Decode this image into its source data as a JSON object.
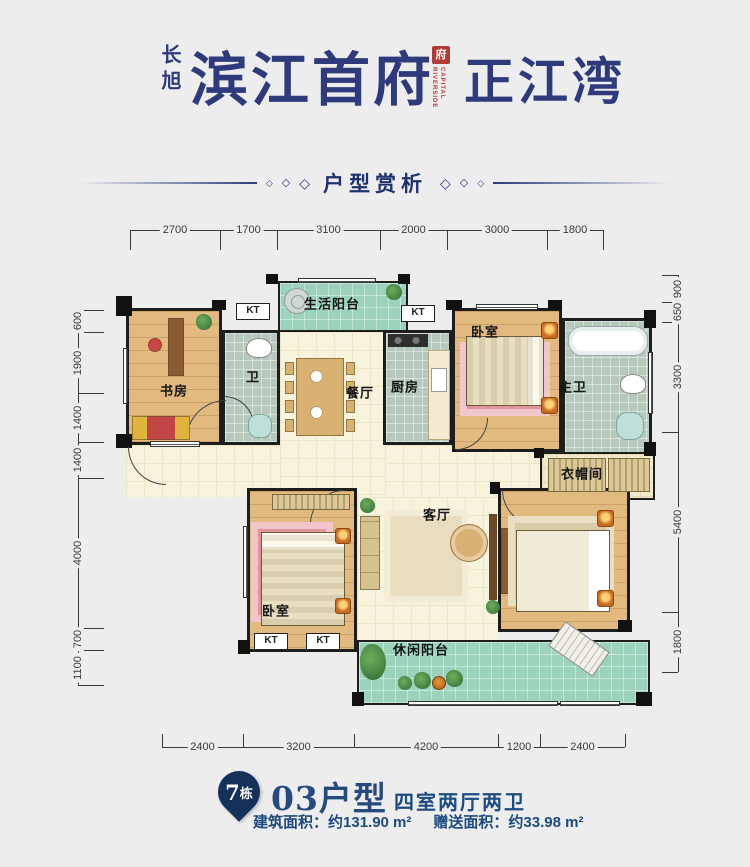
{
  "header": {
    "brand": "长旭",
    "title": "滨江首府",
    "seal_char": "府",
    "seal_caption": "RIVERSIDE CAPITAL",
    "subtitle_right": "正江湾"
  },
  "divider": {
    "label": "户型赏析",
    "diamond": "◇"
  },
  "plan": {
    "kt_text": "KT",
    "floors": [
      [
        "corridor",
        126,
        445,
        154,
        52
      ],
      [
        "dining-hall",
        280,
        332,
        105,
        165
      ],
      [
        "passage",
        385,
        445,
        177,
        52
      ],
      [
        "living-hall",
        357,
        497,
        141,
        143
      ]
    ],
    "rooms": [
      [
        "study",
        "wood",
        126,
        308,
        96,
        137,
        0
      ],
      [
        "bath",
        "tile",
        222,
        330,
        58,
        115,
        0
      ],
      [
        "life-balcony",
        "green",
        278,
        281,
        130,
        51,
        1
      ],
      [
        "kitchen",
        "tile",
        383,
        330,
        69,
        115,
        0
      ],
      [
        "bedroom-north",
        "wood",
        452,
        308,
        110,
        144,
        0
      ],
      [
        "master-bath",
        "tile",
        562,
        318,
        90,
        137,
        0
      ],
      [
        "cloakroom",
        "cream2",
        540,
        452,
        115,
        48,
        1
      ],
      [
        "bedroom-west",
        "wood",
        247,
        488,
        110,
        164,
        0
      ],
      [
        "master-bedroom",
        "wood",
        498,
        488,
        132,
        144,
        0
      ],
      [
        "leisure-balcony",
        "green",
        357,
        640,
        293,
        65,
        1
      ]
    ],
    "room_labels": [
      [
        "书房",
        174,
        390
      ],
      [
        "卫",
        253,
        376
      ],
      [
        "生活阳台",
        332,
        303
      ],
      [
        "餐厅",
        360,
        392
      ],
      [
        "厨房",
        405,
        386
      ],
      [
        "卧室",
        485,
        331
      ],
      [
        "主卫",
        573,
        386
      ],
      [
        "衣帽间",
        582,
        473
      ],
      [
        "客厅",
        437,
        514
      ],
      [
        "卧室",
        276,
        610
      ],
      [
        "休闲阳台",
        421,
        649
      ]
    ],
    "kt_positions": [
      [
        236,
        303
      ],
      [
        401,
        305
      ],
      [
        254,
        633
      ],
      [
        306,
        633
      ]
    ],
    "piers": [
      [
        116,
        296,
        16,
        20
      ],
      [
        212,
        300,
        14,
        10
      ],
      [
        266,
        274,
        12,
        10
      ],
      [
        398,
        274,
        12,
        10
      ],
      [
        446,
        300,
        16,
        10
      ],
      [
        548,
        300,
        14,
        10
      ],
      [
        644,
        310,
        12,
        18
      ],
      [
        644,
        442,
        12,
        14
      ],
      [
        618,
        620,
        14,
        12
      ],
      [
        636,
        692,
        16,
        14
      ],
      [
        352,
        692,
        12,
        14
      ],
      [
        238,
        640,
        12,
        14
      ],
      [
        116,
        434,
        16,
        14
      ],
      [
        490,
        482,
        10,
        12
      ],
      [
        534,
        448,
        10,
        10
      ]
    ],
    "windows": [
      [
        123,
        348,
        5,
        56,
        "v"
      ],
      [
        150,
        441,
        50,
        6,
        "h"
      ],
      [
        298,
        278,
        78,
        5,
        "h"
      ],
      [
        476,
        304,
        62,
        6,
        "h"
      ],
      [
        648,
        352,
        5,
        62,
        "v"
      ],
      [
        243,
        526,
        5,
        72,
        "v"
      ],
      [
        408,
        701,
        150,
        5,
        "h"
      ],
      [
        560,
        701,
        60,
        5,
        "h"
      ]
    ],
    "doors": [
      [
        128,
        447,
        38,
        0
      ],
      [
        186,
        400,
        40,
        90
      ],
      [
        224,
        396,
        30,
        180
      ],
      [
        456,
        418,
        32,
        270
      ],
      [
        310,
        490,
        34,
        90
      ],
      [
        502,
        490,
        36,
        0
      ]
    ],
    "furniture": [
      [
        "desk",
        168,
        318,
        16,
        58,
        0
      ],
      [
        "chair",
        148,
        338,
        14,
        14,
        0
      ],
      [
        "sofa",
        132,
        416,
        58,
        24,
        0
      ],
      [
        "plant",
        196,
        314,
        16,
        16,
        0
      ],
      [
        "toilet",
        246,
        338,
        26,
        20,
        0
      ],
      [
        "sink",
        248,
        414,
        24,
        24,
        0
      ],
      [
        "washer",
        284,
        288,
        26,
        26,
        0
      ],
      [
        "plant",
        386,
        284,
        16,
        16,
        0
      ],
      [
        "table",
        296,
        358,
        48,
        78,
        0
      ],
      [
        "chair-s",
        285,
        362,
        9,
        13,
        0
      ],
      [
        "chair-s",
        285,
        381,
        9,
        13,
        0
      ],
      [
        "chair-s",
        285,
        400,
        9,
        13,
        0
      ],
      [
        "chair-s",
        285,
        419,
        9,
        13,
        0
      ],
      [
        "chair-s",
        346,
        362,
        9,
        13,
        0
      ],
      [
        "chair-s",
        346,
        381,
        9,
        13,
        0
      ],
      [
        "chair-s",
        346,
        400,
        9,
        13,
        0
      ],
      [
        "chair-s",
        346,
        419,
        9,
        13,
        0
      ],
      [
        "plate",
        310,
        370,
        13,
        13,
        0
      ],
      [
        "plate",
        310,
        406,
        13,
        13,
        0
      ],
      [
        "stove",
        388,
        334,
        40,
        13,
        0
      ],
      [
        "counter",
        428,
        350,
        22,
        90,
        0
      ],
      [
        "ksink",
        431,
        368,
        16,
        24,
        0
      ],
      [
        "rug",
        460,
        342,
        90,
        74,
        0
      ],
      [
        "bed-h",
        466,
        336,
        78,
        70,
        0
      ],
      [
        "ns",
        541,
        322,
        17,
        17,
        0
      ],
      [
        "ns",
        541,
        397,
        17,
        17,
        0
      ],
      [
        "tub",
        568,
        326,
        80,
        30,
        0
      ],
      [
        "toilet",
        620,
        374,
        26,
        20,
        0
      ],
      [
        "sink",
        616,
        412,
        28,
        28,
        0
      ],
      [
        "hatch",
        548,
        458,
        58,
        34,
        0
      ],
      [
        "hatch",
        608,
        458,
        42,
        34,
        0
      ],
      [
        "sofa-v",
        360,
        516,
        20,
        74,
        0
      ],
      [
        "rug-c",
        384,
        510,
        84,
        92,
        0
      ],
      [
        "rtable",
        450,
        524,
        38,
        38,
        0
      ],
      [
        "plant",
        360,
        498,
        15,
        15,
        0
      ],
      [
        "tv",
        489,
        514,
        8,
        86,
        0
      ],
      [
        "plant",
        486,
        600,
        14,
        14,
        0
      ],
      [
        "hatch",
        272,
        494,
        78,
        16,
        0
      ],
      [
        "rug",
        251,
        522,
        82,
        100,
        0
      ],
      [
        "bed-v",
        261,
        532,
        84,
        94,
        0
      ],
      [
        "ns",
        335,
        528,
        16,
        16,
        0
      ],
      [
        "ns",
        335,
        598,
        16,
        16,
        0
      ],
      [
        "desk",
        501,
        528,
        13,
        66,
        0
      ],
      [
        "rug2",
        508,
        516,
        106,
        90,
        0
      ],
      [
        "bed-h2",
        516,
        530,
        94,
        82,
        0
      ],
      [
        "ns",
        597,
        510,
        17,
        17,
        0
      ],
      [
        "ns",
        597,
        590,
        17,
        17,
        0
      ],
      [
        "plantbig",
        360,
        644,
        26,
        36,
        0
      ],
      [
        "lounge",
        552,
        634,
        54,
        30,
        35
      ],
      [
        "plant",
        398,
        676,
        14,
        14,
        0
      ],
      [
        "plant",
        414,
        672,
        17,
        17,
        0
      ],
      [
        "pot",
        432,
        676,
        14,
        14,
        0
      ],
      [
        "plant",
        446,
        670,
        17,
        17,
        0
      ]
    ],
    "rulers": [
      {
        "side": "top",
        "dir": "h",
        "line": 230,
        "tick_len": 20,
        "tick_dir": 1,
        "ticks": [
          130,
          220,
          277,
          380,
          447,
          547,
          603
        ],
        "labels": [
          "2700",
          "1700",
          "3100",
          "2000",
          "3000",
          "1800"
        ]
      },
      {
        "side": "bottom",
        "dir": "h",
        "line": 747,
        "tick_len": 13,
        "tick_dir": -1,
        "ticks": [
          162,
          243,
          354,
          498,
          540,
          625
        ],
        "labels": [
          "2400",
          "3200",
          "4200",
          "1200",
          "2400"
        ]
      },
      {
        "side": "left",
        "dir": "v",
        "line": 78,
        "tick_len": 26,
        "tick_dir": 1,
        "ticks": [
          310,
          332,
          393,
          442,
          478,
          628,
          650,
          685
        ],
        "labels": [
          "600",
          "1900",
          "1400",
          "1400",
          "4000",
          "700",
          "1100"
        ]
      },
      {
        "side": "right",
        "dir": "v",
        "line": 678,
        "tick_len": 16,
        "tick_dir": -1,
        "ticks": [
          275,
          302,
          322,
          432,
          612,
          672
        ],
        "labels": [
          "900",
          "650",
          "3300",
          "5400",
          "1800"
        ]
      }
    ]
  },
  "footer": {
    "badge_num": "7",
    "badge_suffix": "栋",
    "unit": "03户型",
    "layout": "四室两厅两卫",
    "build_label": "建筑面积：",
    "build_value": "约131.90 m²",
    "gift_label": "赠送面积：",
    "gift_value": "约33.98 m²"
  }
}
